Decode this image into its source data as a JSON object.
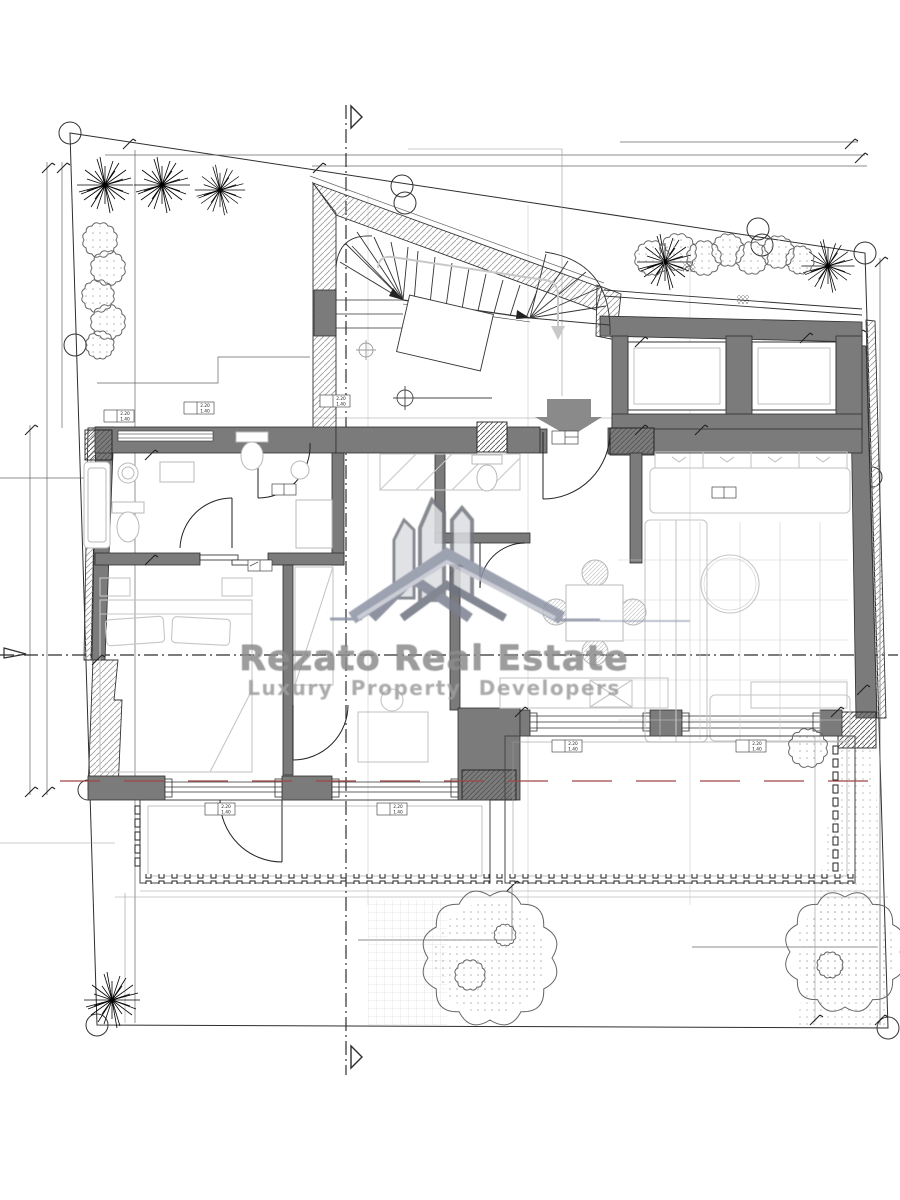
{
  "watermark": {
    "title": "Rezato Real Estate",
    "subtitle": "Luxury Property Developers"
  },
  "window_tag": {
    "top": "2.20",
    "bottom": "1.40"
  },
  "colors": {
    "paper": "#ffffff",
    "wall_gray": "#7b7b7b",
    "line_dark": "#2e2e2e",
    "furniture_gray": "#c6c6c6",
    "red_dashed": "#a04545",
    "watermark_text": "#8c8c8c",
    "logo_roof": "#8d92a4",
    "logo_tower_fill": "#dcdde1",
    "logo_tower_stroke": "#73767f"
  }
}
